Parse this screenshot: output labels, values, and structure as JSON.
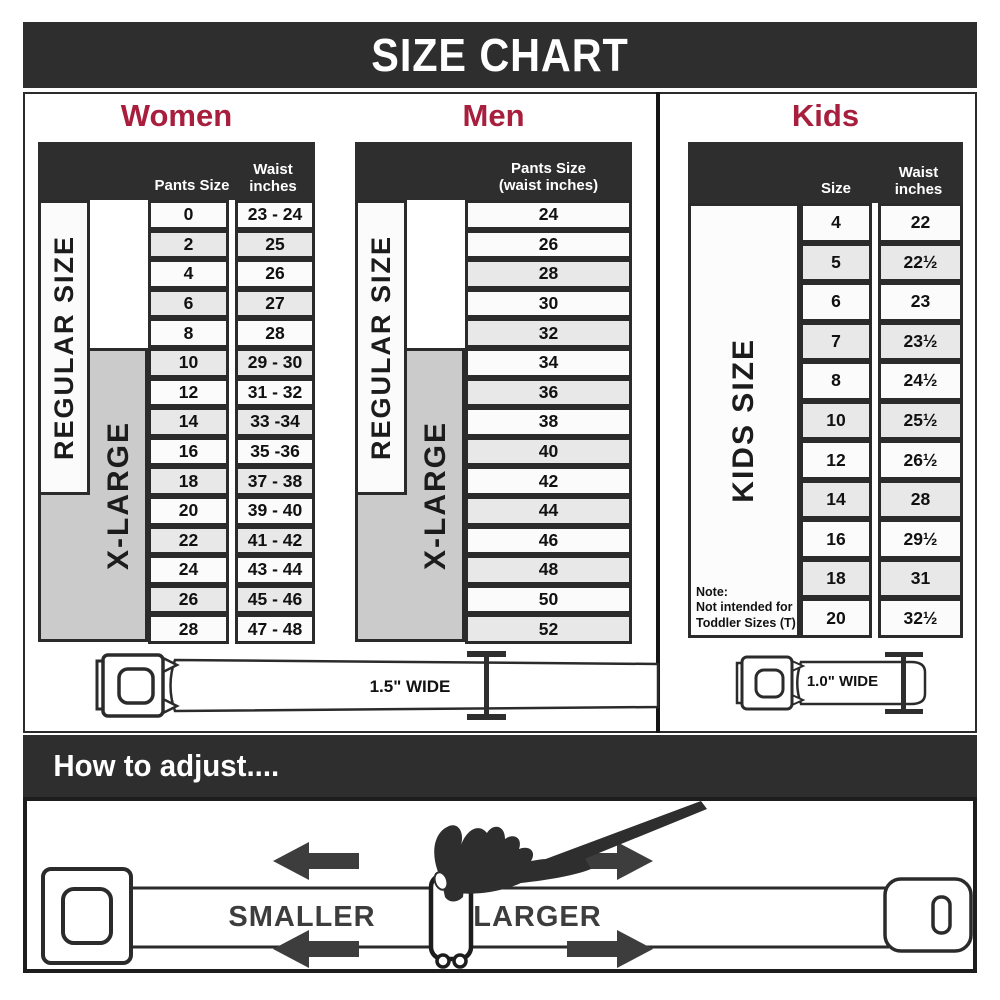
{
  "title": "SIZE CHART",
  "colors": {
    "dark": "#2e2e2e",
    "accent_red": "#a81e3d",
    "row_alt_gray": "#e8e8e8",
    "xlarge_gray": "#cbcbcb"
  },
  "chart_data": [
    {
      "type": "table",
      "title": "Women",
      "columns": [
        "Pants Size",
        "Waist inches"
      ],
      "rows": [
        [
          "0",
          "23 - 24"
        ],
        [
          "2",
          "25"
        ],
        [
          "4",
          "26"
        ],
        [
          "6",
          "27"
        ],
        [
          "8",
          "28"
        ],
        [
          "10",
          "29 - 30"
        ],
        [
          "12",
          "31 - 32"
        ],
        [
          "14",
          "33 -34"
        ],
        [
          "16",
          "35 -36"
        ],
        [
          "18",
          "37 - 38"
        ],
        [
          "20",
          "39 - 40"
        ],
        [
          "22",
          "41 - 42"
        ],
        [
          "24",
          "43 - 44"
        ],
        [
          "26",
          "45 - 46"
        ],
        [
          "28",
          "47 - 48"
        ]
      ],
      "group_spans": [
        {
          "label": "REGULAR SIZE",
          "covers_sizes": "0-18"
        },
        {
          "label": "X-LARGE",
          "covers_sizes": "10-28"
        }
      ]
    },
    {
      "type": "table",
      "title": "Men",
      "columns": [
        "Pants Size (waist inches)"
      ],
      "rows": [
        [
          "24"
        ],
        [
          "26"
        ],
        [
          "28"
        ],
        [
          "30"
        ],
        [
          "32"
        ],
        [
          "34"
        ],
        [
          "36"
        ],
        [
          "38"
        ],
        [
          "40"
        ],
        [
          "42"
        ],
        [
          "44"
        ],
        [
          "46"
        ],
        [
          "48"
        ],
        [
          "50"
        ],
        [
          "52"
        ]
      ],
      "group_spans": [
        {
          "label": "REGULAR SIZE",
          "covers_sizes": "24-42"
        },
        {
          "label": "X-LARGE",
          "covers_sizes": "34-52"
        }
      ]
    },
    {
      "type": "table",
      "title": "Kids",
      "columns": [
        "Size",
        "Waist inches"
      ],
      "rows": [
        [
          "4",
          "22"
        ],
        [
          "5",
          "22½"
        ],
        [
          "6",
          "23"
        ],
        [
          "7",
          "23½"
        ],
        [
          "8",
          "24½"
        ],
        [
          "10",
          "25½"
        ],
        [
          "12",
          "26½"
        ],
        [
          "14",
          "28"
        ],
        [
          "16",
          "29½"
        ],
        [
          "18",
          "31"
        ],
        [
          "20",
          "32½"
        ]
      ],
      "group_spans": [
        {
          "label": "KIDS SIZE",
          "covers_sizes": "4-20"
        }
      ]
    }
  ],
  "women": {
    "pants_size_header": "Pants Size",
    "waist_line1": "Waist",
    "waist_line2": "inches",
    "regular_label": "REGULAR SIZE",
    "xlarge_label": "X-LARGE"
  },
  "men": {
    "pants_line1": "Pants Size",
    "pants_line2": "(waist inches)",
    "regular_label": "REGULAR SIZE",
    "xlarge_label": "X-LARGE"
  },
  "kids": {
    "size_header": "Size",
    "waist_line1": "Waist",
    "waist_line2": "inches",
    "kids_size_label": "KIDS SIZE",
    "note_title": "Note:",
    "note_body": "Not intended for Toddler Sizes (T)"
  },
  "belts": {
    "adult_width_label": "1.5\" WIDE",
    "kids_width_label": "1.0\" WIDE"
  },
  "adjust": {
    "heading": "How to adjust....",
    "smaller_label": "SMALLER",
    "larger_label": "LARGER"
  }
}
